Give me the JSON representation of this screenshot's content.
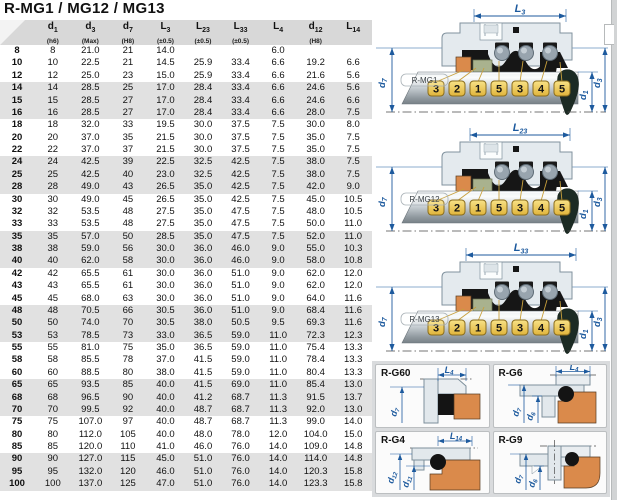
{
  "title": "R-MG1 / MG12 / MG13",
  "colors": {
    "dimension_blue": "#1d5a9e",
    "seat_orange": "#da8a4b",
    "tag_gold": "#e9bf49",
    "row_stripe": "#e1e1e1",
    "header_gray": "#d8d8d8"
  },
  "table": {
    "headers": [
      {
        "base": "",
        "sub": "",
        "tol": ""
      },
      {
        "base": "d",
        "sub": "1",
        "tol": "(h6)"
      },
      {
        "base": "d",
        "sub": "3",
        "tol": "(Max)"
      },
      {
        "base": "d",
        "sub": "7",
        "tol": "(H8)"
      },
      {
        "base": "L",
        "sub": "3",
        "tol": "(±0.5)"
      },
      {
        "base": "L",
        "sub": "23",
        "tol": "(±0.5)"
      },
      {
        "base": "L",
        "sub": "33",
        "tol": "(±0.5)"
      },
      {
        "base": "L",
        "sub": "4",
        "tol": ""
      },
      {
        "base": "d",
        "sub": "12",
        "tol": "(H8)"
      },
      {
        "base": "L",
        "sub": "14",
        "tol": ""
      }
    ],
    "rows": [
      [
        "8",
        "8",
        "21.0",
        "21",
        "14.0",
        "",
        "",
        "6.0",
        "",
        ""
      ],
      [
        "10",
        "10",
        "22.5",
        "21",
        "14.5",
        "25.9",
        "33.4",
        "6.6",
        "19.2",
        "6.6"
      ],
      [
        "12",
        "12",
        "25.0",
        "23",
        "15.0",
        "25.9",
        "33.4",
        "6.6",
        "21.6",
        "5.6"
      ],
      [
        "14",
        "14",
        "28.5",
        "25",
        "17.0",
        "28.4",
        "33.4",
        "6.6",
        "24.6",
        "5.6"
      ],
      [
        "15",
        "15",
        "28.5",
        "27",
        "17.0",
        "28.4",
        "33.4",
        "6.6",
        "24.6",
        "6.6"
      ],
      [
        "16",
        "16",
        "28.5",
        "27",
        "17.0",
        "28.4",
        "33.4",
        "6.6",
        "28.0",
        "7.5"
      ],
      [
        "18",
        "18",
        "32.0",
        "33",
        "19.5",
        "30.0",
        "37.5",
        "7.5",
        "30.0",
        "8.0"
      ],
      [
        "20",
        "20",
        "37.0",
        "35",
        "21.5",
        "30.0",
        "37.5",
        "7.5",
        "35.0",
        "7.5"
      ],
      [
        "22",
        "22",
        "37.0",
        "37",
        "21.5",
        "30.0",
        "37.5",
        "7.5",
        "35.0",
        "7.5"
      ],
      [
        "24",
        "24",
        "42.5",
        "39",
        "22.5",
        "32.5",
        "42.5",
        "7.5",
        "38.0",
        "7.5"
      ],
      [
        "25",
        "25",
        "42.5",
        "40",
        "23.0",
        "32.5",
        "42.5",
        "7.5",
        "38.0",
        "7.5"
      ],
      [
        "28",
        "28",
        "49.0",
        "43",
        "26.5",
        "35.0",
        "42.5",
        "7.5",
        "42.0",
        "9.0"
      ],
      [
        "30",
        "30",
        "49.0",
        "45",
        "26.5",
        "35.0",
        "42.5",
        "7.5",
        "45.0",
        "10.5"
      ],
      [
        "32",
        "32",
        "53.5",
        "48",
        "27.5",
        "35.0",
        "47.5",
        "7.5",
        "48.0",
        "10.5"
      ],
      [
        "33",
        "33",
        "53.5",
        "48",
        "27.5",
        "35.0",
        "47.5",
        "7.5",
        "50.0",
        "11.0"
      ],
      [
        "35",
        "35",
        "57.0",
        "50",
        "28.5",
        "35.0",
        "47.5",
        "7.5",
        "52.0",
        "11.0"
      ],
      [
        "38",
        "38",
        "59.0",
        "56",
        "30.0",
        "36.0",
        "46.0",
        "9.0",
        "55.0",
        "10.3"
      ],
      [
        "40",
        "40",
        "62.0",
        "58",
        "30.0",
        "36.0",
        "46.0",
        "9.0",
        "58.0",
        "10.8"
      ],
      [
        "42",
        "42",
        "65.5",
        "61",
        "30.0",
        "36.0",
        "51.0",
        "9.0",
        "62.0",
        "12.0"
      ],
      [
        "43",
        "43",
        "65.5",
        "61",
        "30.0",
        "36.0",
        "51.0",
        "9.0",
        "62.0",
        "12.0"
      ],
      [
        "45",
        "45",
        "68.0",
        "63",
        "30.0",
        "36.0",
        "51.0",
        "9.0",
        "64.0",
        "11.6"
      ],
      [
        "48",
        "48",
        "70.5",
        "66",
        "30.5",
        "36.0",
        "51.0",
        "9.0",
        "68.4",
        "11.6"
      ],
      [
        "50",
        "50",
        "74.0",
        "70",
        "30.5",
        "38.0",
        "50.5",
        "9.5",
        "69.3",
        "11.6"
      ],
      [
        "53",
        "53",
        "78.5",
        "73",
        "33.0",
        "36.5",
        "59.0",
        "11.0",
        "72.3",
        "12.3"
      ],
      [
        "55",
        "55",
        "81.0",
        "75",
        "35.0",
        "36.5",
        "59.0",
        "11.0",
        "75.4",
        "13.3"
      ],
      [
        "58",
        "58",
        "85.5",
        "78",
        "37.0",
        "41.5",
        "59.0",
        "11.0",
        "78.4",
        "13.3"
      ],
      [
        "60",
        "60",
        "88.5",
        "80",
        "38.0",
        "41.5",
        "59.0",
        "11.0",
        "80.4",
        "13.3"
      ],
      [
        "65",
        "65",
        "93.5",
        "85",
        "40.0",
        "41.5",
        "69.0",
        "11.0",
        "85.4",
        "13.0"
      ],
      [
        "68",
        "68",
        "96.5",
        "90",
        "40.0",
        "41.2",
        "68.7",
        "11.3",
        "91.5",
        "13.7"
      ],
      [
        "70",
        "70",
        "99.5",
        "92",
        "40.0",
        "48.7",
        "68.7",
        "11.3",
        "92.0",
        "13.0"
      ],
      [
        "75",
        "75",
        "107.0",
        "97",
        "40.0",
        "48.7",
        "68.7",
        "11.3",
        "99.0",
        "14.0"
      ],
      [
        "80",
        "80",
        "112.0",
        "105",
        "40.0",
        "48.0",
        "78.0",
        "12.0",
        "104.0",
        "15.0"
      ],
      [
        "85",
        "85",
        "120.0",
        "110",
        "41.0",
        "46.0",
        "76.0",
        "14.0",
        "109.0",
        "14.8"
      ],
      [
        "90",
        "90",
        "127.0",
        "115",
        "45.0",
        "51.0",
        "76.0",
        "14.0",
        "114.0",
        "14.8"
      ],
      [
        "95",
        "95",
        "132.0",
        "120",
        "46.0",
        "51.0",
        "76.0",
        "14.0",
        "120.3",
        "15.8"
      ],
      [
        "100",
        "100",
        "137.0",
        "125",
        "47.0",
        "51.0",
        "76.0",
        "14.0",
        "123.3",
        "15.8"
      ]
    ]
  },
  "diagrams": [
    {
      "name": "R-MG1",
      "top_dim": {
        "base": "L",
        "sub": "3"
      },
      "left_dim": {
        "base": "d",
        "sub": "7"
      },
      "right_dims": [
        {
          "base": "d",
          "sub": "1"
        },
        {
          "base": "d",
          "sub": "3"
        }
      ],
      "tags": [
        "3",
        "2",
        "1",
        "5",
        "3",
        "4",
        "5"
      ]
    },
    {
      "name": "R-MG12",
      "top_dim": {
        "base": "L",
        "sub": "23"
      },
      "left_dim": {
        "base": "d",
        "sub": "7"
      },
      "right_dims": [
        {
          "base": "d",
          "sub": "1"
        },
        {
          "base": "d",
          "sub": "3"
        }
      ],
      "tags": [
        "3",
        "2",
        "1",
        "5",
        "3",
        "4",
        "5"
      ]
    },
    {
      "name": "R-MG13",
      "top_dim": {
        "base": "L",
        "sub": "33"
      },
      "left_dim": {
        "base": "d",
        "sub": "7"
      },
      "right_dims": [
        {
          "base": "d",
          "sub": "1"
        },
        {
          "base": "d",
          "sub": "3"
        }
      ],
      "tags": [
        "3",
        "2",
        "1",
        "5",
        "3",
        "4",
        "5"
      ]
    }
  ],
  "seats": [
    {
      "name": "R-G60",
      "top_dim": {
        "base": "L",
        "sub": "4"
      },
      "v_dims": [
        {
          "base": "d",
          "sub": "7"
        }
      ]
    },
    {
      "name": "R-G6",
      "top_dim": {
        "base": "L",
        "sub": "4"
      },
      "v_dims": [
        {
          "base": "d",
          "sub": "7"
        },
        {
          "base": "d",
          "sub": "6"
        }
      ]
    },
    {
      "name": "R-G4",
      "top_dim": {
        "base": "L",
        "sub": "14"
      },
      "v_dims": [
        {
          "base": "d",
          "sub": "12"
        },
        {
          "base": "d",
          "sub": "11"
        }
      ]
    },
    {
      "name": "R-G9",
      "top_dim": null,
      "v_dims": [
        {
          "base": "d",
          "sub": "7"
        },
        {
          "base": "d",
          "sub": "6"
        }
      ]
    }
  ]
}
